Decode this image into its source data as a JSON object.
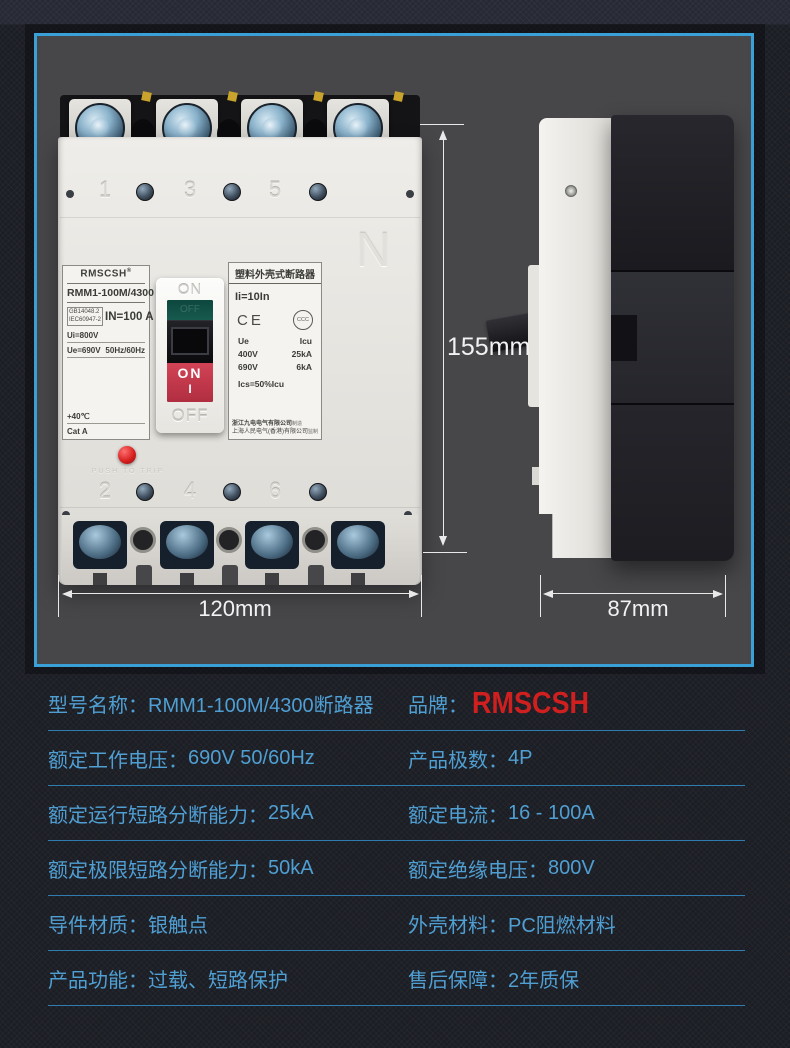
{
  "colors": {
    "accent": "#3aa0d8",
    "spec_text": "#4f9fd3",
    "brand_red": "#d01f1f"
  },
  "photo_panel": {
    "front": {
      "brand": "RMSCSH",
      "registered": "®",
      "model": "RMM1-100M/4300",
      "standard1": "GB14048.2",
      "standard2": "IEC60947-2",
      "rated_current": "IN=100 A",
      "ui": "Ui=800V",
      "ue": "Ue=690V",
      "freq": "50Hz/60Hz",
      "temp": "+40℃",
      "category": "Cat  A",
      "neutral": "N",
      "poles_top": [
        "1",
        "3",
        "5"
      ],
      "poles_bottom": [
        "2",
        "4",
        "6"
      ],
      "toggle_on": "ON",
      "toggle_off": "OFF",
      "window_off": "OFF",
      "handle_on": "ON",
      "handle_i": "I",
      "push_to_trip": "PUSH TO TRIP",
      "nameplate": {
        "title": "塑料外壳式断路器",
        "ii": "Ii=10In",
        "ce": "CE",
        "ccc": "CCC",
        "col_ue": "Ue",
        "col_icu": "Icu",
        "row1_ue": "400V",
        "row1_icu": "25kA",
        "row2_ue": "690V",
        "row2_icu": "6kA",
        "ics": "Ics=50%Icu",
        "manufacturer": "浙江九电电气有限公司",
        "manufacturer_tag": "制造",
        "supervisor": "上海人民电气(香港)有限公司",
        "supervisor_tag": "监制"
      }
    },
    "dimensions": {
      "height": "155mm",
      "width": "120mm",
      "depth": "87mm"
    }
  },
  "specs": {
    "rows": [
      {
        "l_label": "型号名称：",
        "l_value": "RMM1-100M/4300断路器",
        "r_label": "品牌：",
        "r_value": "RMSCSH"
      },
      {
        "l_label": "额定工作电压：",
        "l_value": "690V 50/60Hz",
        "r_label": "产品极数：",
        "r_value": "4P"
      },
      {
        "l_label": "额定运行短路分断能力：",
        "l_value": "25kA",
        "r_label": "额定电流：",
        "r_value": "16 - 100A"
      },
      {
        "l_label": "额定极限短路分断能力：",
        "l_value": "50kA",
        "r_label": "额定绝缘电压：",
        "r_value": "800V"
      },
      {
        "l_label": "导件材质：",
        "l_value": "银触点",
        "r_label": "外壳材料：",
        "r_value": "PC阻燃材料"
      },
      {
        "l_label": "产品功能：",
        "l_value": "过载、短路保护",
        "r_label": "售后保障：",
        "r_value": "2年质保"
      }
    ]
  }
}
